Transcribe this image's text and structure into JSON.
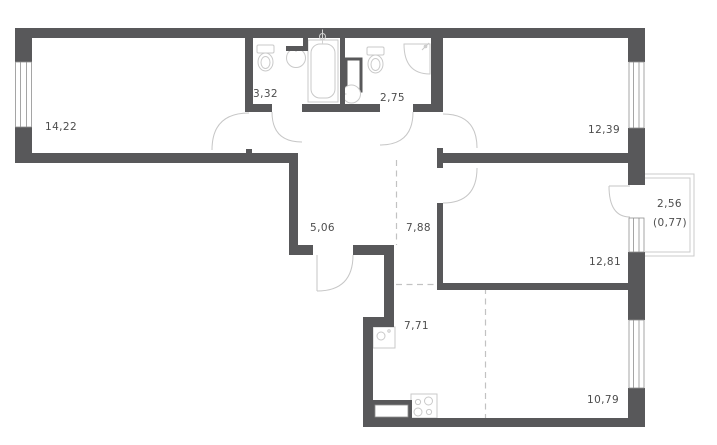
{
  "plan": {
    "type": "apartment-floor-plan",
    "wall_color": "#58585a",
    "fixture_line_color": "#c9c9c9",
    "dashed_zone_color": "#c2c2c2",
    "label_color": "#4d4d4d",
    "rooms": [
      {
        "name": "room-large",
        "area": "14,22"
      },
      {
        "name": "bathroom",
        "area": "3,32"
      },
      {
        "name": "toilet-shower-room",
        "area": "2,75"
      },
      {
        "name": "bedroom-top-right",
        "area": "12,39"
      },
      {
        "name": "closet",
        "area": "5,06"
      },
      {
        "name": "hallway",
        "area": "7,88"
      },
      {
        "name": "bedroom-right",
        "area": "12,81"
      },
      {
        "name": "balcony",
        "area": "2,56",
        "area_coefficient": "(0,77)"
      },
      {
        "name": "kitchen",
        "area": "7,71"
      },
      {
        "name": "living-area",
        "area": "10,79"
      }
    ]
  }
}
